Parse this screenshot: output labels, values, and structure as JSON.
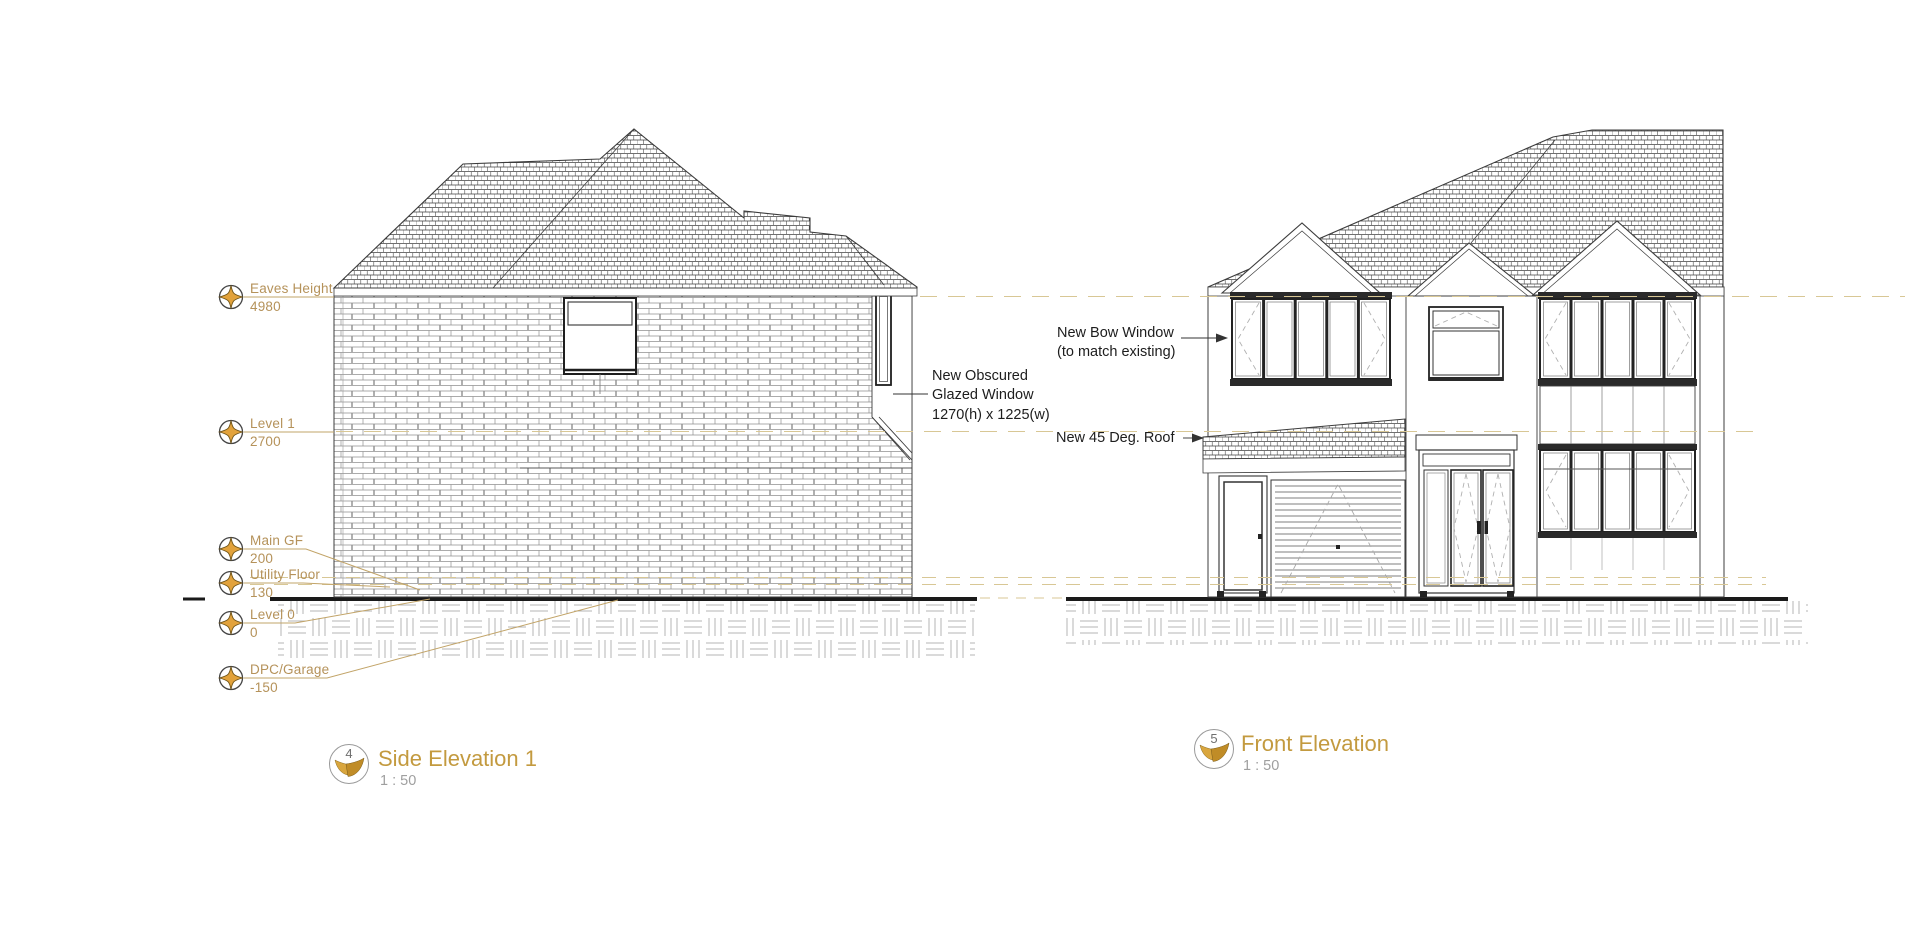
{
  "sheet": {
    "background": "#ffffff",
    "colors": {
      "accent_gold": "#c39a3f",
      "level_text": "#b5925a",
      "level_dash_line": "#d8c795",
      "annotation_text": "#1d1d1d",
      "drawing_line": "#3c3c3c"
    },
    "icons": {
      "level_datum": "level-datum-star-icon",
      "view_logo": "gold-wings-logo-icon",
      "leader_arrow": "arrow-right-icon"
    }
  },
  "side_elevation": {
    "levels": [
      {
        "name": "Eaves Height",
        "value": "4980"
      },
      {
        "name": "Level 1",
        "value": "2700"
      },
      {
        "name": "Main GF",
        "value": "200"
      },
      {
        "name": "Utility Floor",
        "value": "130"
      },
      {
        "name": "Level 0",
        "value": "0"
      },
      {
        "name": "DPC/Garage",
        "value": "-150"
      }
    ],
    "annotation_obscured_window": {
      "line1": "New Obscured",
      "line2": "Glazed Window",
      "line3": "1270(h) x 1225(w)"
    },
    "title": {
      "number": "4",
      "name": "Side Elevation 1",
      "scale": "1 : 50"
    }
  },
  "front_elevation": {
    "annotation_bow_window": {
      "line1": "New Bow Window",
      "line2": "(to match existing)"
    },
    "annotation_roof": "New 45 Deg. Roof",
    "title": {
      "number": "5",
      "name": "Front Elevation",
      "scale": "1 : 50"
    }
  }
}
